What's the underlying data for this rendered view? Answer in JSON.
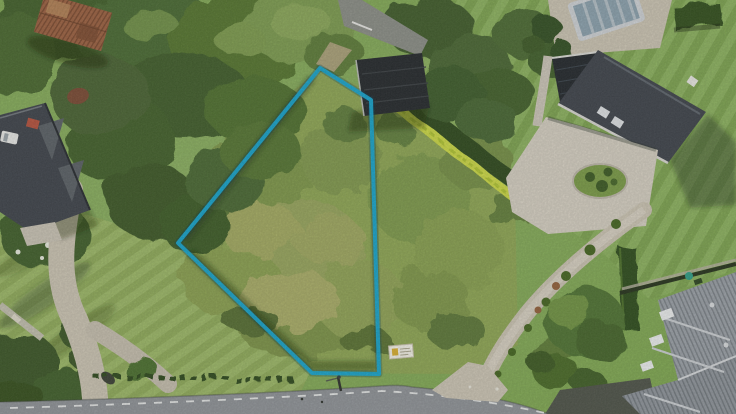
{
  "meta": {
    "kind": "aerial-drone-photo",
    "width_px": 736,
    "height_px": 414
  },
  "annotation": {
    "label": "plot-boundary-outline",
    "color": "#16a6cf",
    "glow": "rgba(8,70,95,0.28)",
    "stroke_width": 4,
    "points": "320,68 371,100 379,374 312,373 178,243"
  },
  "palette": {
    "lawn": "#7ea74f",
    "lawn_light": "#97b45e",
    "meadow": "#8ea653",
    "canopy": "#46652e",
    "hedge_dark": "#2d491d",
    "hedge_yellow": "#ccd944",
    "road": "#8f9397",
    "road_marking": "#eceeec",
    "gravel": "#cbc4b2",
    "courtyard": "#d5cfc1",
    "roof_dark": "#3e434a",
    "roof_black": "#24282b",
    "roof_ribbed": "#9aa0a6",
    "shed_rust": "#9c6140",
    "chimney_red": "#b5513c",
    "pool_cover": "#8ba1ad",
    "pool_deck": "#cfd3d6",
    "sign_board": "#f2f0e5"
  }
}
